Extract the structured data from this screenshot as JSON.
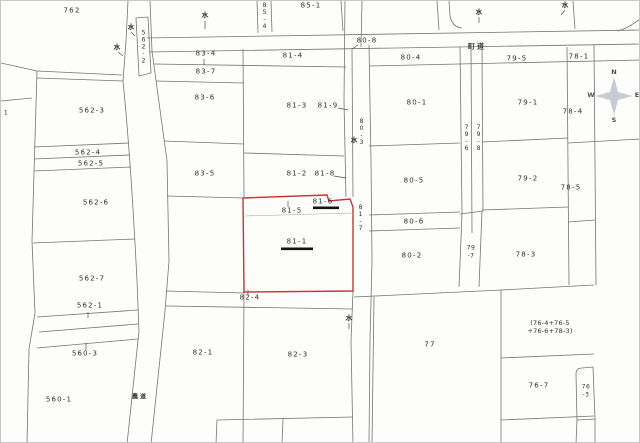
{
  "map": {
    "highlighted_parcel": "81-1",
    "underlined_parcels": [
      "81-1",
      "81-6"
    ],
    "road_labels": [
      "町道",
      "農道"
    ]
  },
  "colors": {
    "highlight_outline": "#c63333",
    "boundary": "#767472",
    "emphasis_bar": "#131313",
    "compass_fill": "#c8ccd0",
    "compass_stroke": "#989da2"
  },
  "compass": {
    "n": "N",
    "e": "E",
    "s": "S",
    "w": "W"
  },
  "labels": [
    {
      "text": "762",
      "x": 71,
      "y": 10
    },
    {
      "text": "85-1",
      "x": 310,
      "y": 5
    },
    {
      "text": "85-4",
      "x": 263,
      "y": 15,
      "cls": "vertical tiny"
    },
    {
      "text": "562-2",
      "x": 142,
      "y": 46,
      "cls": "vertical tiny"
    },
    {
      "text": "80-8",
      "x": 366,
      "y": 40
    },
    {
      "text": "町道",
      "x": 476,
      "y": 46,
      "cls": "road",
      "name": "road-label-chodo"
    },
    {
      "text": "83-4",
      "x": 205,
      "y": 53
    },
    {
      "text": "81-4",
      "x": 292,
      "y": 55
    },
    {
      "text": "80-4",
      "x": 410,
      "y": 57
    },
    {
      "text": "79-5",
      "x": 516,
      "y": 58
    },
    {
      "text": "78-1",
      "x": 578,
      "y": 56
    },
    {
      "text": "83-7",
      "x": 205,
      "y": 71
    },
    {
      "text": "83-6",
      "x": 204,
      "y": 97
    },
    {
      "text": "81-3",
      "x": 296,
      "y": 105
    },
    {
      "text": "81-9",
      "x": 327,
      "y": 105
    },
    {
      "text": "80-1",
      "x": 416,
      "y": 102
    },
    {
      "text": "79-1",
      "x": 527,
      "y": 102
    },
    {
      "text": "562-3",
      "x": 91,
      "y": 110
    },
    {
      "text": "78-4",
      "x": 572,
      "y": 111
    },
    {
      "text": "1",
      "x": 5,
      "y": 112,
      "cls": "tiny"
    },
    {
      "text": "80-3",
      "x": 360,
      "y": 131,
      "cls": "vertical tiny"
    },
    {
      "text": "79-6",
      "x": 465,
      "y": 137,
      "cls": "vertical tiny"
    },
    {
      "text": "79-8",
      "x": 477,
      "y": 137,
      "cls": "vertical tiny"
    },
    {
      "text": "562-4",
      "x": 87,
      "y": 152
    },
    {
      "text": "562-5",
      "x": 90,
      "y": 163
    },
    {
      "text": "83-5",
      "x": 204,
      "y": 173
    },
    {
      "text": "81-2",
      "x": 296,
      "y": 173
    },
    {
      "text": "81-8",
      "x": 324,
      "y": 173
    },
    {
      "text": "80-5",
      "x": 413,
      "y": 180
    },
    {
      "text": "79-2",
      "x": 527,
      "y": 178
    },
    {
      "text": "78-5",
      "x": 570,
      "y": 187
    },
    {
      "text": "562-6",
      "x": 95,
      "y": 202
    },
    {
      "text": "81-6",
      "x": 322,
      "y": 201,
      "name": "parcel-label-81-6-underlined"
    },
    {
      "text": "81-5",
      "x": 291,
      "y": 210
    },
    {
      "text": "81-7",
      "x": 359,
      "y": 217,
      "cls": "vertical tiny"
    },
    {
      "text": "80-6",
      "x": 413,
      "y": 221
    },
    {
      "text": "81-1",
      "x": 296,
      "y": 241,
      "name": "parcel-label-81-1-highlighted"
    },
    {
      "text": "80-2",
      "x": 411,
      "y": 255
    },
    {
      "text": "79\n-7",
      "x": 470,
      "y": 251,
      "cls": "tiny"
    },
    {
      "text": "78-3",
      "x": 525,
      "y": 254
    },
    {
      "text": "562-7",
      "x": 91,
      "y": 278
    },
    {
      "text": "562-1",
      "x": 89,
      "y": 305
    },
    {
      "text": "82-4",
      "x": 249,
      "y": 297
    },
    {
      "text": "(76-4+76-5\n+76-6+78-3)",
      "x": 549,
      "y": 326,
      "cls": "small"
    },
    {
      "text": "560-3",
      "x": 84,
      "y": 353
    },
    {
      "text": "82-1",
      "x": 202,
      "y": 352
    },
    {
      "text": "82-3",
      "x": 297,
      "y": 354
    },
    {
      "text": "77",
      "x": 429,
      "y": 344
    },
    {
      "text": "76-7",
      "x": 538,
      "y": 385
    },
    {
      "text": "76\n-3",
      "x": 585,
      "y": 390,
      "cls": "tiny"
    },
    {
      "text": "560-1",
      "x": 58,
      "y": 399
    },
    {
      "text": "農道",
      "x": 139,
      "y": 396,
      "cls": "road tiny",
      "name": "road-label-nodo"
    },
    {
      "text": "水",
      "x": 204,
      "y": 14,
      "cls": "mark",
      "name": "water-mark"
    },
    {
      "text": "水",
      "x": 130,
      "y": 26,
      "cls": "mark",
      "name": "water-mark"
    },
    {
      "text": "水",
      "x": 116,
      "y": 46,
      "cls": "mark",
      "name": "water-mark"
    },
    {
      "text": "水",
      "x": 353,
      "y": 139,
      "cls": "mark",
      "name": "water-mark"
    },
    {
      "text": "水",
      "x": 348,
      "y": 317,
      "cls": "mark",
      "name": "water-mark"
    },
    {
      "text": "水",
      "x": 564,
      "y": 4,
      "cls": "mark",
      "name": "water-mark"
    },
    {
      "text": "水",
      "x": 478,
      "y": 11,
      "cls": "mark",
      "name": "water-mark"
    }
  ]
}
